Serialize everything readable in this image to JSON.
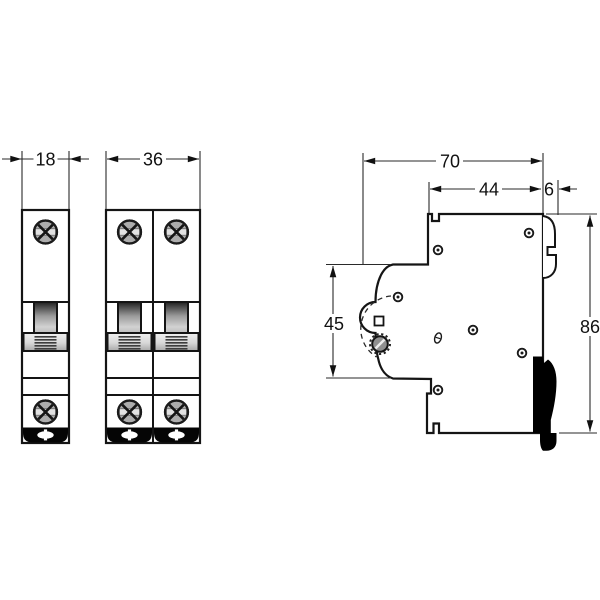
{
  "dimensions": {
    "front_single_width": "18",
    "front_double_width": "36",
    "side_depth_overall": "70",
    "side_depth_upper": "44",
    "side_rail_claw": "6",
    "side_front_height": "45",
    "side_height_overall": "86"
  },
  "colors": {
    "line": "#1a1a1a",
    "background": "#ffffff",
    "metal_gray": "#a8a8a8",
    "clip_black": "#000000"
  }
}
